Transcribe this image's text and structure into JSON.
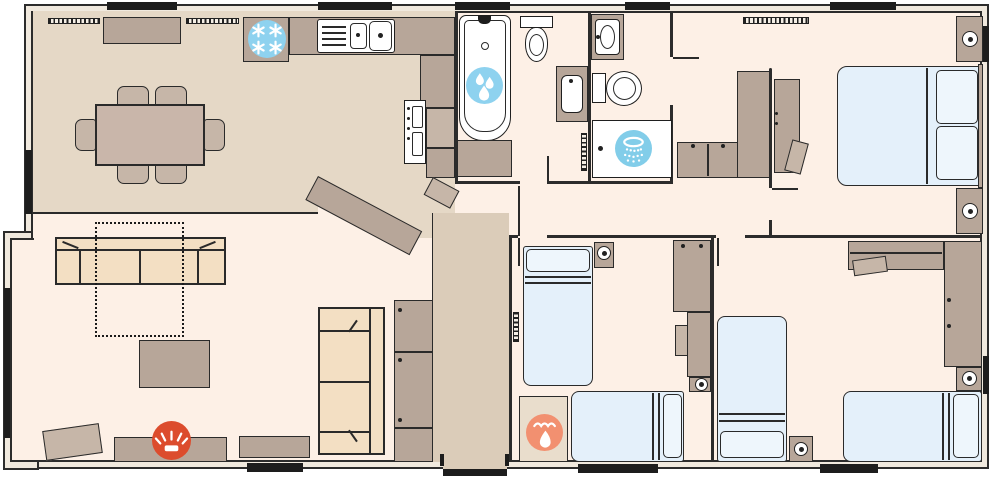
{
  "floorplan": {
    "kind": "holiday-lodge-static-caravan-floor-plan",
    "text_labels": [],
    "rooms": [
      {
        "id": "dining-kitchen",
        "furniture": [
          "dining-table-6-chairs",
          "sideboard",
          "fridge-freezer",
          "sink-drainer",
          "cooker",
          "worktops",
          "breakfast-peninsula"
        ]
      },
      {
        "id": "lounge",
        "furniture": [
          "three-seat-sofa",
          "sofa-bed-dashed-outline",
          "coffee-table",
          "tv-unit-with-electric-fire",
          "side-table",
          "storage-unit",
          "two-seat-sofa"
        ]
      },
      {
        "id": "bathroom",
        "furniture": [
          "bath",
          "toilet",
          "basin",
          "radiator"
        ]
      },
      {
        "id": "en-suite-shower-room",
        "furniture": [
          "shower-enclosure",
          "toilet",
          "basin",
          "vanity-cupboard"
        ]
      },
      {
        "id": "master-bedroom",
        "furniture": [
          "double-bed",
          "two-bedside-cabinets-with-lamps",
          "wardrobe",
          "dressing-table",
          "stool",
          "radiator"
        ]
      },
      {
        "id": "hallway",
        "furniture": [
          "cupboard-stack",
          "entrance-door"
        ]
      },
      {
        "id": "twin-bedroom-1",
        "furniture": [
          "two-single-beds",
          "wardrobe",
          "chest-of-drawers",
          "stool",
          "bedside-cabinets-with-lamps",
          "boiler-cupboard"
        ]
      },
      {
        "id": "twin-bedroom-2",
        "furniture": [
          "two-single-beds",
          "wardrobe",
          "desk",
          "stool",
          "bedside-cabinets-with-lamps"
        ]
      }
    ],
    "features": [
      {
        "id": "fridge-freezer",
        "icon": "snowflake-icon",
        "circle_color": "#8ed2ef",
        "glyph_color": "#ffffff",
        "location": "kitchen"
      },
      {
        "id": "bath",
        "icon": "water-drops-icon",
        "circle_color": "#8ed2ef",
        "glyph_color": "#ffffff",
        "location": "bathroom"
      },
      {
        "id": "shower",
        "icon": "shower-head-icon",
        "circle_color": "#82cde9",
        "glyph_color": "#ffffff",
        "location": "en-suite-shower-room"
      },
      {
        "id": "electric-fire",
        "icon": "fire-glow-icon",
        "circle_color": "#dc4c2d",
        "glyph_color": "#ffffff",
        "location": "lounge"
      },
      {
        "id": "boiler",
        "icon": "flame-icon",
        "circle_color": "#f29070",
        "glyph_color": "#ffffff",
        "location": "twin-bedroom-1"
      }
    ],
    "palette": {
      "wall": "#2c2c2c",
      "outer_wall_band": "#f0e9de",
      "floor_light": "#fdf0e6",
      "floor_dining": "#e5d8c6",
      "floor_hall": "#dbccb9",
      "furniture_taupe": "#b7a699",
      "furniture_light": "#c6b6a8",
      "sofa": "#f3dfc3",
      "bed_blue": "#e4f0fa",
      "pillow": "#eef6fc",
      "exterior_bar": "#1d1d1d",
      "boiler_cupboard": "#e9ddcc"
    }
  }
}
